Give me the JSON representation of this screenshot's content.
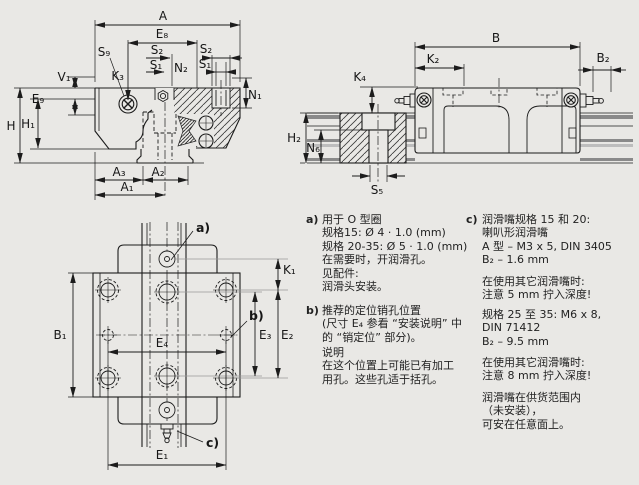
{
  "colors": {
    "background": "#e9e8e5",
    "line": "#1c1c1c",
    "extension_gray": "#999999",
    "rail_band_dark": "#8a8a8a",
    "rail_band_light": "#bdbdbd"
  },
  "labels": {
    "A": "A",
    "E8": "E₈",
    "S2": "S₂",
    "S1": "S₁",
    "N2": "N₂",
    "N1": "N₁",
    "S9": "S₉",
    "K3": "K₃",
    "V1": "V₁",
    "E9": "E₉",
    "H": "H",
    "H1": "H₁",
    "A3": "A₃",
    "A2": "A₂",
    "A1": "A₁",
    "B": "B",
    "K2": "K₂",
    "B2": "B₂",
    "K4": "K₄",
    "H2": "H₂",
    "N6": "N₆",
    "S5": "S₅",
    "B1": "B₁",
    "K1": "K₁",
    "E4": "E₄",
    "E3": "E₃",
    "E2": "E₂",
    "E1": "E₁"
  },
  "notes": {
    "a": {
      "marker": "a)",
      "lines": [
        "用于 O 型圈",
        "规格15: Ø 4 · 1.0 (mm)",
        "规格 20-35: Ø 5 · 1.0 (mm)",
        "在需要时，开润滑孔。",
        "见配件:",
        "润滑头安装。"
      ]
    },
    "b": {
      "marker": "b)",
      "para1": [
        "推荐的定位销孔位置",
        "(尺寸 E₄ 参看 “安装说明” 中",
        "的 “销定位” 部分)。"
      ],
      "para2": [
        "说明",
        "在这个位置上可能已有加工",
        "用孔。这些孔适于括孔。"
      ]
    },
    "c": {
      "marker": "c)",
      "para1": [
        "润滑嘴规格 15 和 20:",
        "喇叭形润滑嘴",
        "A 型 – M3 x 5, DIN 3405",
        "B₂ – 1.6 mm"
      ],
      "para2": [
        "在使用其它润滑嘴时:",
        "注意 5 mm 拧入深度!"
      ],
      "para3": [
        "规格 25 至 35: M6 x 8,",
        "DIN 71412",
        "B₂ – 9.5 mm"
      ],
      "para4": [
        "在使用其它润滑嘴时:",
        "注意 8 mm 拧入深度!"
      ],
      "para5": [
        "润滑嘴在供货范围内",
        "（未安装），",
        "可安在任意面上。"
      ]
    },
    "leader_a": "a)",
    "leader_b": "b)",
    "leader_c": "c)"
  }
}
